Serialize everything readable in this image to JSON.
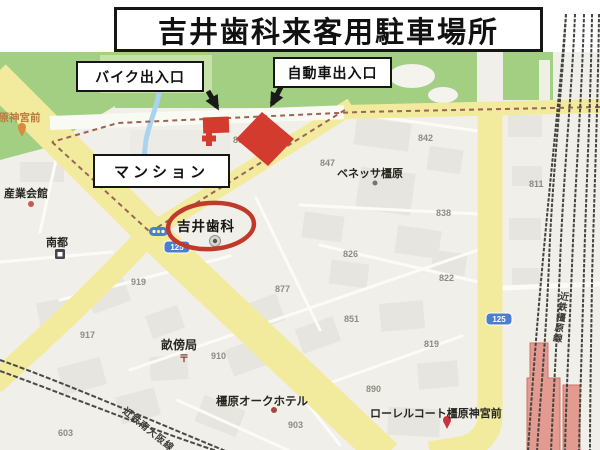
{
  "title": "吉井歯科来客用駐車場所",
  "callouts": {
    "bike_label": "バイク出入口",
    "car_label": "自動車出入口",
    "mansion_label": "マンション"
  },
  "map": {
    "clinic_name": "吉井歯科",
    "station_name": "橿原神宮前",
    "rail_line_vertical": "近鉄橿原線",
    "rail_line_sw": "近鉄南大阪線",
    "post_mark": "〒",
    "route_shields": [
      {
        "num": "125"
      },
      {
        "num": "125"
      }
    ],
    "place_labels": [
      {
        "text": "産業会館",
        "x": 4,
        "y": 197,
        "size": 11
      },
      {
        "text": "南都",
        "x": 46,
        "y": 246,
        "size": 11
      },
      {
        "text": "ベネッサ橿原",
        "x": 337,
        "y": 177,
        "size": 11
      },
      {
        "text": "畝傍局",
        "x": 161,
        "y": 349,
        "size": 12
      },
      {
        "text": "橿原オークホテル",
        "x": 216,
        "y": 405,
        "size": 11.5
      },
      {
        "text": "ローレルコート橿原神宮前",
        "x": 370,
        "y": 417,
        "size": 11
      }
    ],
    "block_numbers": [
      {
        "t": "861",
        "x": 233,
        "y": 143
      },
      {
        "t": "847",
        "x": 320,
        "y": 166
      },
      {
        "t": "842",
        "x": 418,
        "y": 141
      },
      {
        "t": "811",
        "x": 529,
        "y": 187
      },
      {
        "t": "838",
        "x": 436,
        "y": 216
      },
      {
        "t": "826",
        "x": 343,
        "y": 257
      },
      {
        "t": "877",
        "x": 275,
        "y": 292
      },
      {
        "t": "822",
        "x": 439,
        "y": 281
      },
      {
        "t": "851",
        "x": 344,
        "y": 322
      },
      {
        "t": "819",
        "x": 424,
        "y": 347
      },
      {
        "t": "919",
        "x": 131,
        "y": 285
      },
      {
        "t": "917",
        "x": 80,
        "y": 338
      },
      {
        "t": "910",
        "x": 211,
        "y": 359
      },
      {
        "t": "903",
        "x": 288,
        "y": 428
      },
      {
        "t": "890",
        "x": 366,
        "y": 392
      },
      {
        "t": "603",
        "x": 58,
        "y": 436
      }
    ]
  },
  "colors": {
    "annotation_red": "#d23b2e",
    "circle_red": "#c0392b",
    "road_yellow": "#f2eb9e",
    "park_green": "#a2cf82",
    "shield_blue": "#4a7fd0",
    "station_pink": "#e29a91",
    "water_blue": "#a8d4f2"
  }
}
